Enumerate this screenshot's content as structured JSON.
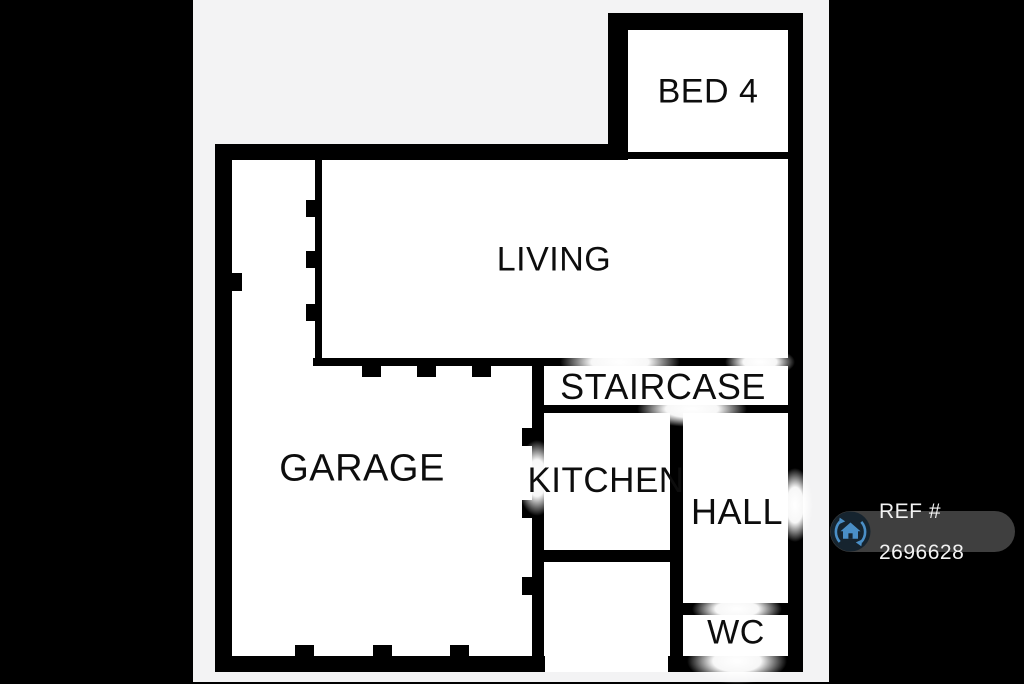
{
  "floorplan": {
    "rooms": [
      {
        "name": "bed4",
        "label": "BED 4"
      },
      {
        "name": "living",
        "label": "LIVING"
      },
      {
        "name": "staircase",
        "label": "STAIRCASE"
      },
      {
        "name": "garage",
        "label": "GARAGE"
      },
      {
        "name": "kitchen",
        "label": "KITCHEN"
      },
      {
        "name": "hall",
        "label": "HALL"
      },
      {
        "name": "wc",
        "label": "WC"
      }
    ],
    "colors": {
      "wall": "#000000",
      "room_fill": "#ffffff",
      "canvas_bg": "#f3f3f4",
      "letterbox_bg": "#000000"
    }
  },
  "ref_badge": {
    "label": "REF # 2696628",
    "background": "#3f3f3f",
    "text_color": "#f2f2f2",
    "icon": {
      "name": "house-sync-icon",
      "circle_color": "#16242f",
      "glyph_color": "#4a8fc7"
    }
  }
}
